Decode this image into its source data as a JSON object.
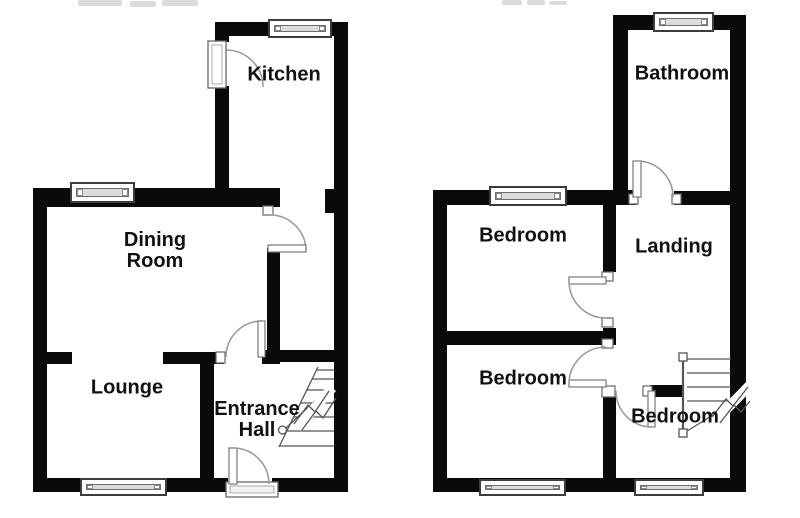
{
  "colors": {
    "wall": "#0a0a0a",
    "background": "#ffffff",
    "door_line": "#999999",
    "window_bar": "#dcdcdc",
    "text": "#111111"
  },
  "rooms": [
    {
      "label": "Kitchen"
    },
    {
      "label": "Dining Room"
    },
    {
      "label": "Lounge"
    },
    {
      "label": "Entrance Hall"
    },
    {
      "label": "Bathroom"
    },
    {
      "label": "Bedroom"
    },
    {
      "label": "Landing"
    },
    {
      "label": "Bedroom"
    },
    {
      "label": "Bedroom"
    }
  ]
}
